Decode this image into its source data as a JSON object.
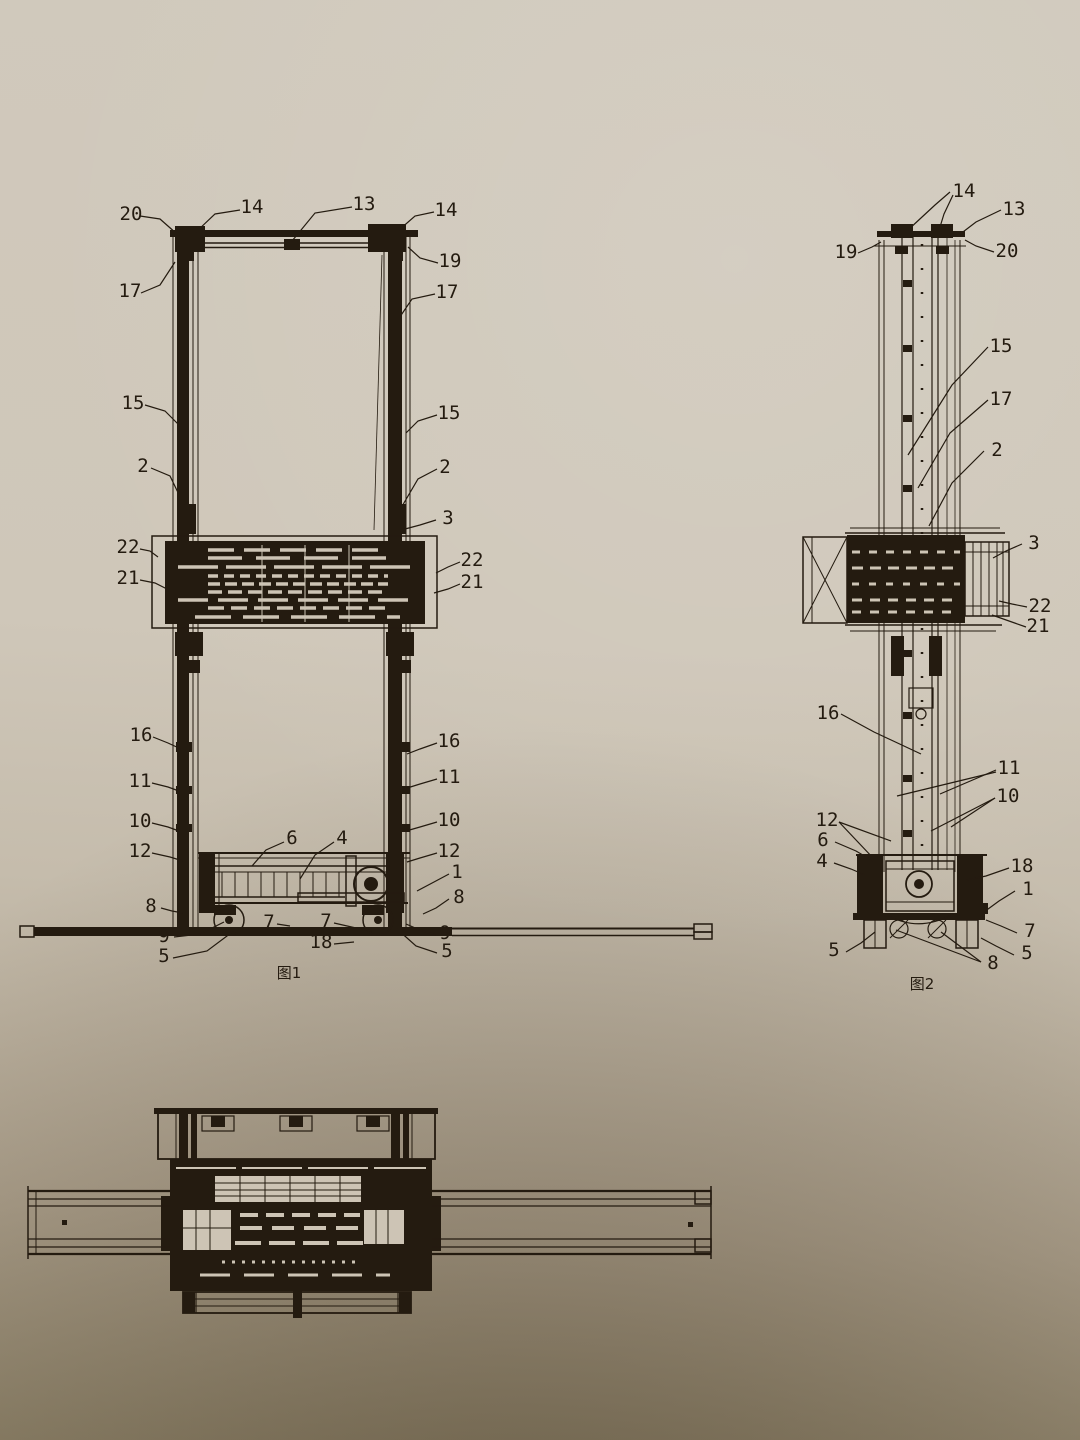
{
  "colors": {
    "ink": "#241b10",
    "paper": "#cdc4b5",
    "paper_top": "#d0c9bc",
    "paper_bottom": "#93886f"
  },
  "fig1": {
    "caption": "图1",
    "labels": {
      "p20": "20",
      "p14L": "14",
      "p13": "13",
      "p14R": "14",
      "p19": "19",
      "p17L": "17",
      "p17R": "17",
      "p15L": "15",
      "p15R": "15",
      "p2L": "2",
      "p2R": "2",
      "p3": "3",
      "p22L": "22",
      "p21L": "21",
      "p22R": "22",
      "p21R": "21",
      "p16L": "16",
      "p16R": "16",
      "p11L": "11",
      "p11R": "11",
      "p10L": "10",
      "p10R": "10",
      "p12L": "12",
      "p12R": "12",
      "p6": "6",
      "p4": "4",
      "p1": "1",
      "p8L": "8",
      "p8R": "8",
      "p9L": "9",
      "p5L": "5",
      "p7a": "7",
      "p7b": "7",
      "p18": "18",
      "p9R": "9",
      "p5R": "5"
    }
  },
  "fig2": {
    "caption": "图2",
    "labels": {
      "p14": "14",
      "p13": "13",
      "p19": "19",
      "p20": "20",
      "p15": "15",
      "p17": "17",
      "p2": "2",
      "p3": "3",
      "p22": "22",
      "p21": "21",
      "p16": "16",
      "p11": "11",
      "p10": "10",
      "p12": "12",
      "p6": "6",
      "p4": "4",
      "p18": "18",
      "p1": "1",
      "p7": "7",
      "p5L": "5",
      "p5R": "5",
      "p8": "8"
    }
  }
}
